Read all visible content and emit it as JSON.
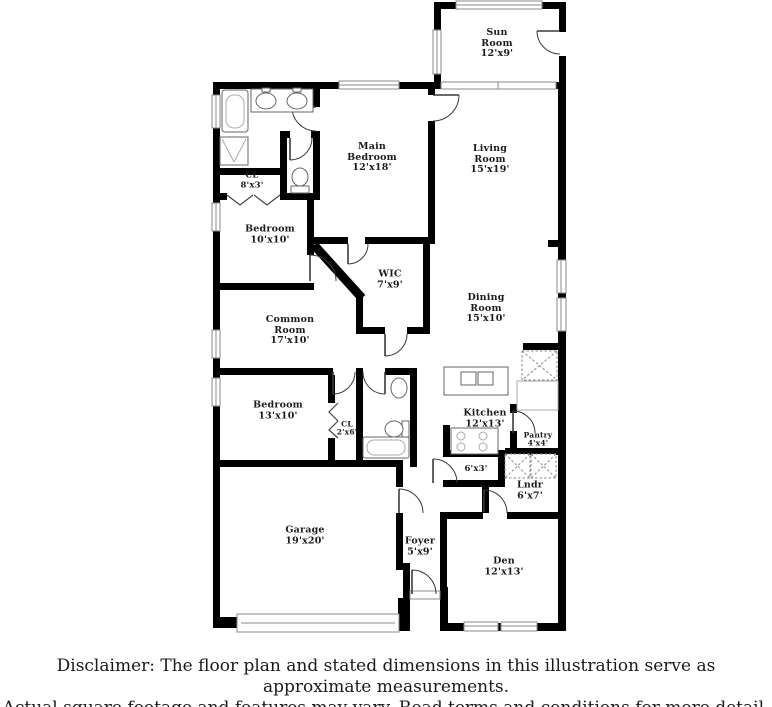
{
  "floor_plan": {
    "rooms": {
      "sun_room": {
        "name": "Sun Room",
        "dims": "12'x9'"
      },
      "main_bedroom": {
        "name": "Main Bedroom",
        "dims": "12'x18'"
      },
      "living_room": {
        "name": "Living Room",
        "dims": "15'x19'"
      },
      "closet_hall": {
        "name": "CL",
        "dims": "8'x3'"
      },
      "bedroom_front": {
        "name": "Bedroom",
        "dims": "10'x10'"
      },
      "wic": {
        "name": "WIC",
        "dims": "7'x9'"
      },
      "dining_room": {
        "name": "Dining Room",
        "dims": "15'x10'"
      },
      "common_room": {
        "name": "Common Room",
        "dims": "17'x10'"
      },
      "bedroom_middle": {
        "name": "Bedroom",
        "dims": "13'x10'"
      },
      "closet_small": {
        "name": "CL",
        "dims": "2'x6'"
      },
      "kitchen": {
        "name": "Kitchen",
        "dims": "12'x13'"
      },
      "pantry": {
        "name": "Pantry",
        "dims": "4'x4'"
      },
      "hall": {
        "name": "",
        "dims": "6'x3'"
      },
      "laundry": {
        "name": "Lndr",
        "dims": "6'x7'"
      },
      "garage": {
        "name": "Garage",
        "dims": "19'x20'"
      },
      "foyer": {
        "name": "Foyer",
        "dims": "5'x9'"
      },
      "den": {
        "name": "Den",
        "dims": "12'x13'"
      }
    },
    "colors": {
      "wall": "#000000",
      "window_border": "#8a8a8a",
      "fixture": "#666666"
    }
  },
  "footer": {
    "line1": "Disclaimer: The floor plan and stated dimensions in this illustration serve as approximate measurements.",
    "line2": "Actual square footage and features may vary. Read terms and conditions for more detail. © PlanOmatic"
  }
}
